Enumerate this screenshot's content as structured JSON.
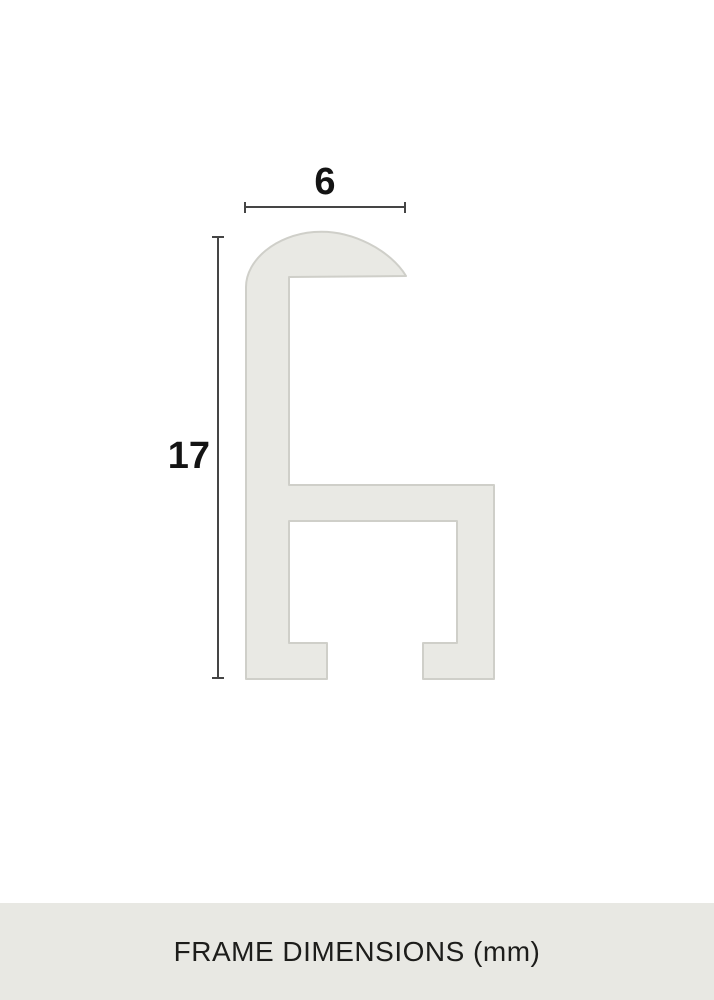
{
  "diagram": {
    "width_label": "6",
    "height_label": "17"
  },
  "caption": {
    "text": "FRAME DIMENSIONS (mm)"
  },
  "colors": {
    "background": "#ffffff",
    "profile_fill": "#e9e9e4",
    "profile_stroke": "#cfcfc9",
    "dimension_color": "#454545",
    "label_color": "#141414",
    "caption_bg": "#e8e8e3",
    "caption_color": "#1d1d1b"
  }
}
